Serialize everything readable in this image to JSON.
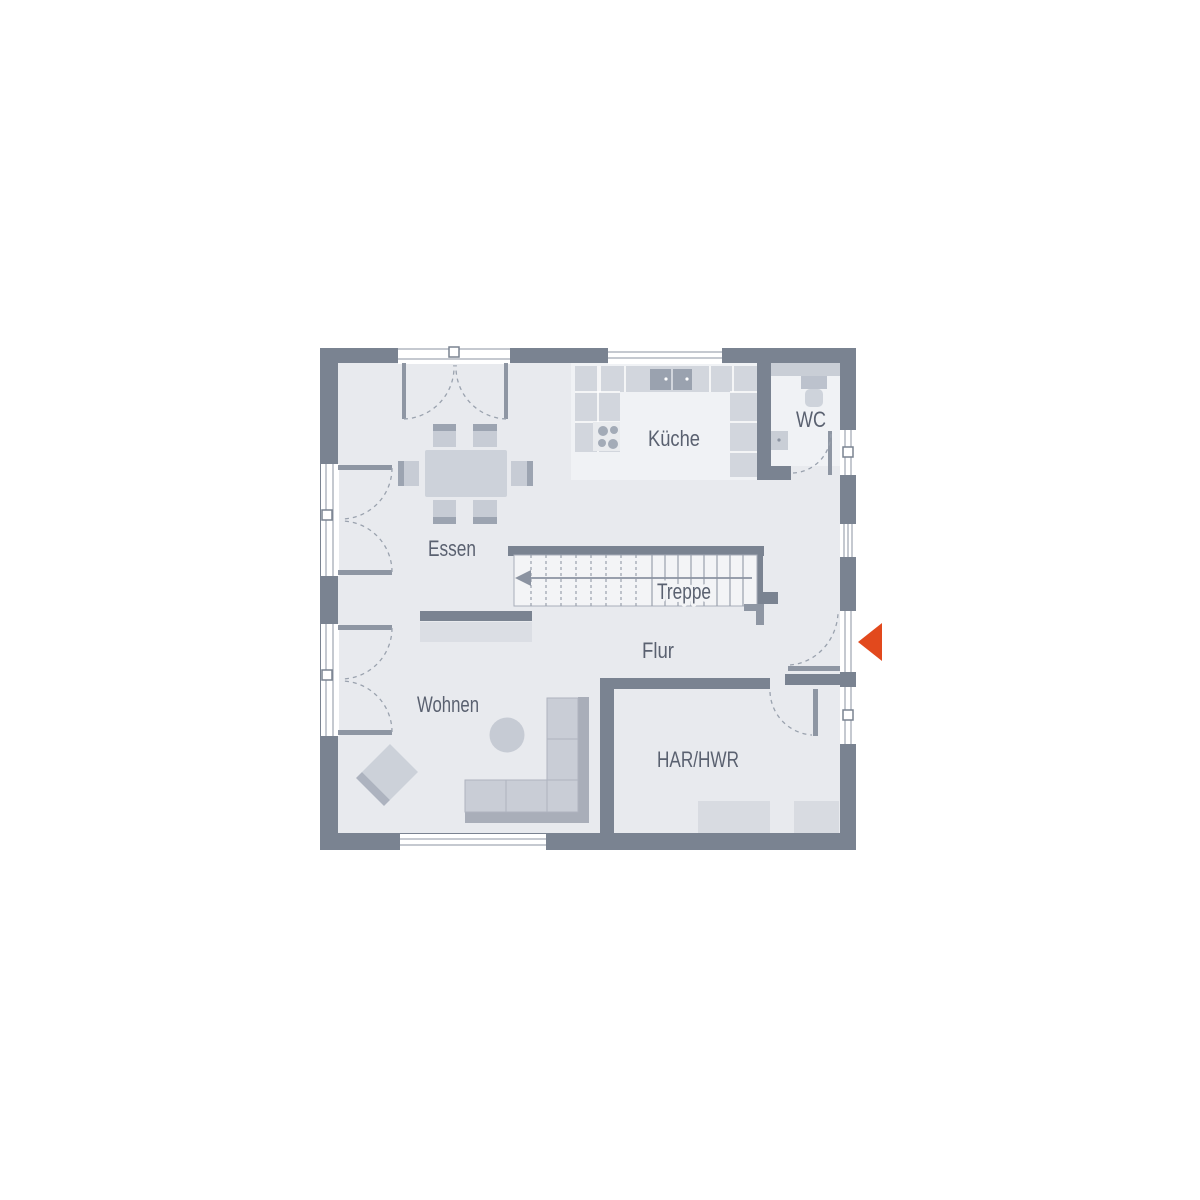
{
  "plan": {
    "type": "floor-plan",
    "rooms": {
      "essen": {
        "label": "Essen"
      },
      "kueche": {
        "label": "Küche"
      },
      "wc": {
        "label": "WC"
      },
      "treppe": {
        "label": "Treppe"
      },
      "flur": {
        "label": "Flur"
      },
      "wohnen": {
        "label": "Wohnen"
      },
      "har_hwr": {
        "label": "HAR/HWR"
      }
    },
    "icons": {
      "entrance_arrow": "entrance-direction-marker",
      "stairs_arrow": "stairs-up-direction-arrow"
    },
    "colors": {
      "wall": "#7a8391",
      "floor": "#e8eaee",
      "floor_light": "#f0f2f5",
      "stair_fill": "#f3f4f6",
      "counter": "#d2d6dd",
      "appliance_dark": "#9aa2af",
      "furniture_light": "#c9cdd6",
      "furniture_dark": "#a9aeb9",
      "table": "#cdd2da",
      "door_leaf": "#8e96a3",
      "arc_dash": "#9aa2ae",
      "label_text": "#5a6170",
      "entrance_arrow": "#e2491d"
    }
  }
}
